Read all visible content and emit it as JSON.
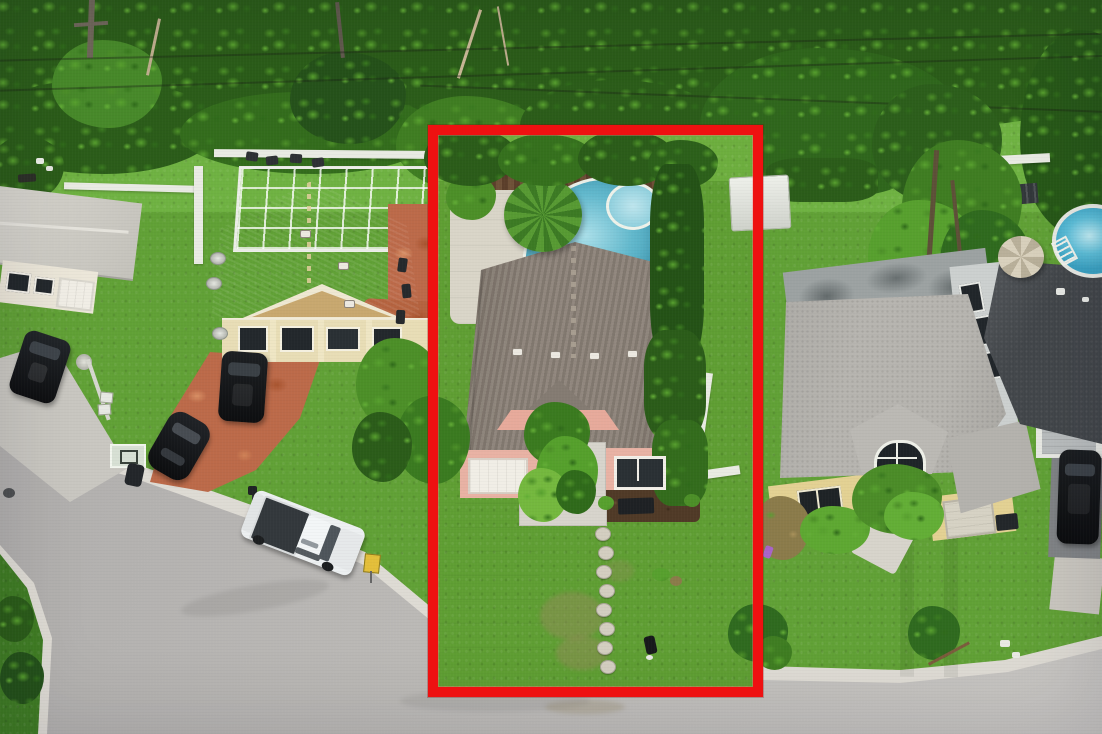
{
  "image": {
    "width": 1102,
    "height": 734,
    "kind": "aerial-drone-photograph",
    "subject": "residential neighborhood with red-outlined listed property"
  },
  "highlight": {
    "x": 428,
    "y": 125,
    "width": 335,
    "height": 572,
    "border_px": 10,
    "color": "#ee1111"
  },
  "colors": {
    "highlight_red": "#ee1111",
    "road": "#b3b1ae",
    "road_light": "#c8c6c3",
    "curb": "#dedbd4",
    "grass": "#61a136",
    "grass_light": "#74b446",
    "grass_dark": "#3f7c24",
    "foliage_dark": "#2b5c19",
    "foliage_mid": "#3f7d22",
    "foliage_light": "#5ea52f",
    "foliage_bright": "#7cc04a",
    "concrete": "#d4d1ca",
    "concrete_dim": "#c9c7c1",
    "terracotta": "#bc6a49",
    "terracotta_light": "#d28a64",
    "tan_roof": "#c7a26b",
    "tan_roof_light": "#e2cf9d",
    "center_roof": "#8b8177",
    "center_roof_light": "#a79d90",
    "pink_wall": "#e9b2a4",
    "pink_trim": "#e7aa9b",
    "white_paint": "#f1eee6",
    "gray_roof": "#b7b5b0",
    "flat_roof": "#9ca2a2",
    "charcoal_roof": "#42464a",
    "yellow_wall": "#e3d193",
    "cream_wall": "#ece7d9",
    "pool_blue": "#58b3c9",
    "pool_blue_light": "#aadfe9",
    "deck": "#d9d5c8",
    "wood_fence": "#6a4c36",
    "white_fence": "#e9ebe3",
    "mulch": "#503a27",
    "vehicle_black": "#131517",
    "truck_white": "#edf0f1",
    "truck_bed": "#33383c",
    "sign_yellow": "#e4bf3a"
  },
  "scene": {
    "generated": {
      "power-line": {
        "cls": "pline",
        "items": [
          [
            -20,
            46,
            -1.4,
            1160
          ],
          [
            -20,
            72,
            -1.8,
            1160
          ],
          [
            420,
            98,
            2.2,
            700
          ]
        ]
      },
      "stepping-stone": {
        "cls": "stone",
        "items": [
          [
            595,
            527
          ],
          [
            598,
            546
          ],
          [
            596,
            565
          ],
          [
            599,
            584
          ],
          [
            596,
            603
          ],
          [
            599,
            622
          ],
          [
            597,
            641
          ],
          [
            600,
            660
          ]
        ]
      },
      "roof-vent": {
        "cls": "vent",
        "items": [
          [
            512,
            348
          ],
          [
            550,
            351
          ],
          [
            589,
            352
          ],
          [
            627,
            350
          ],
          [
            338,
            262
          ],
          [
            344,
            300
          ],
          [
            300,
            230
          ]
        ]
      },
      "satellite-dish": {
        "cls": "dish",
        "items": [
          [
            210,
            252
          ],
          [
            206,
            277
          ],
          [
            212,
            327
          ]
        ]
      },
      "patio-item": {
        "cls": "pitem",
        "items": [
          [
            246,
            152,
            8
          ],
          [
            266,
            156,
            -6
          ],
          [
            290,
            154,
            4
          ],
          [
            312,
            158,
            -8
          ]
        ]
      },
      "patio-furniture": {
        "cls": "furn",
        "items": [
          [
            398,
            258,
            8
          ],
          [
            402,
            284,
            -6
          ],
          [
            396,
            310,
            3
          ]
        ]
      }
    }
  }
}
